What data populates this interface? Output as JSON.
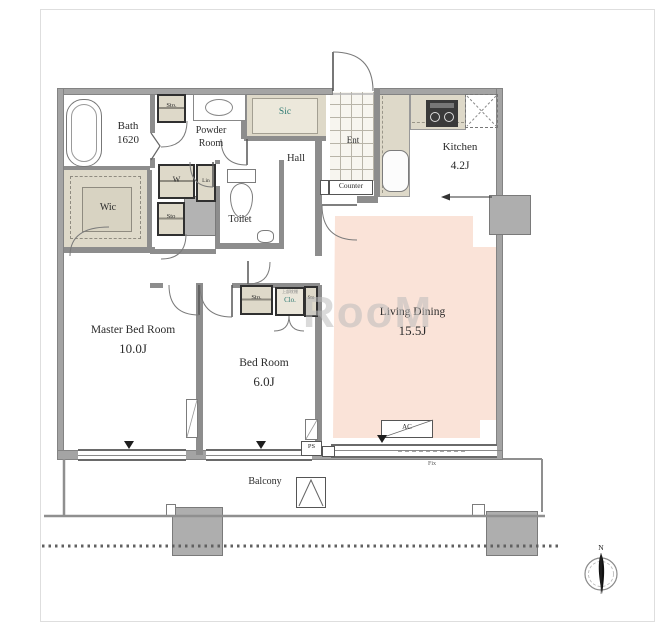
{
  "plan": {
    "watermark": "RooM",
    "compass": {
      "north_label": "N"
    },
    "rooms": {
      "bath": {
        "name": "Bath",
        "size": "1620"
      },
      "powder_room": {
        "line1": "Powder",
        "line2": "Room"
      },
      "wic": {
        "name": "Wic"
      },
      "toilet": {
        "name": "Toilet"
      },
      "hall": {
        "name": "Hall"
      },
      "entrance": {
        "name": "Ent"
      },
      "sic": {
        "name": "Sic"
      },
      "kitchen": {
        "name": "Kitchen",
        "size": "4.2J"
      },
      "living_dining": {
        "name": "Living Dining",
        "size": "15.5J"
      },
      "master_bedroom": {
        "name": "Master Bed Room",
        "size": "10.0J"
      },
      "bedroom": {
        "name": "Bed Room",
        "size": "6.0J"
      },
      "balcony": {
        "name": "Balcony"
      }
    },
    "fixtures": {
      "counter": "Counter",
      "sto_upper": "Sto.",
      "washer": "W",
      "linen": "Lin",
      "sto_lower": "Sto",
      "bedroom_sto": "Sto.",
      "bedroom_clo": "Clo.",
      "bedroom_clo_note": "上部枕棚",
      "bedroom_sto_narrow": "Sto",
      "ps": "PS",
      "ac": "AC",
      "fix_window": "Fix"
    },
    "colors": {
      "living_floor": "#fae3d8",
      "closet_beige": "#ded9c9",
      "accent_teal": "#2e7a72",
      "wall_gray": "#a4a4a4",
      "pillar_gray": "#aeaeae"
    }
  }
}
